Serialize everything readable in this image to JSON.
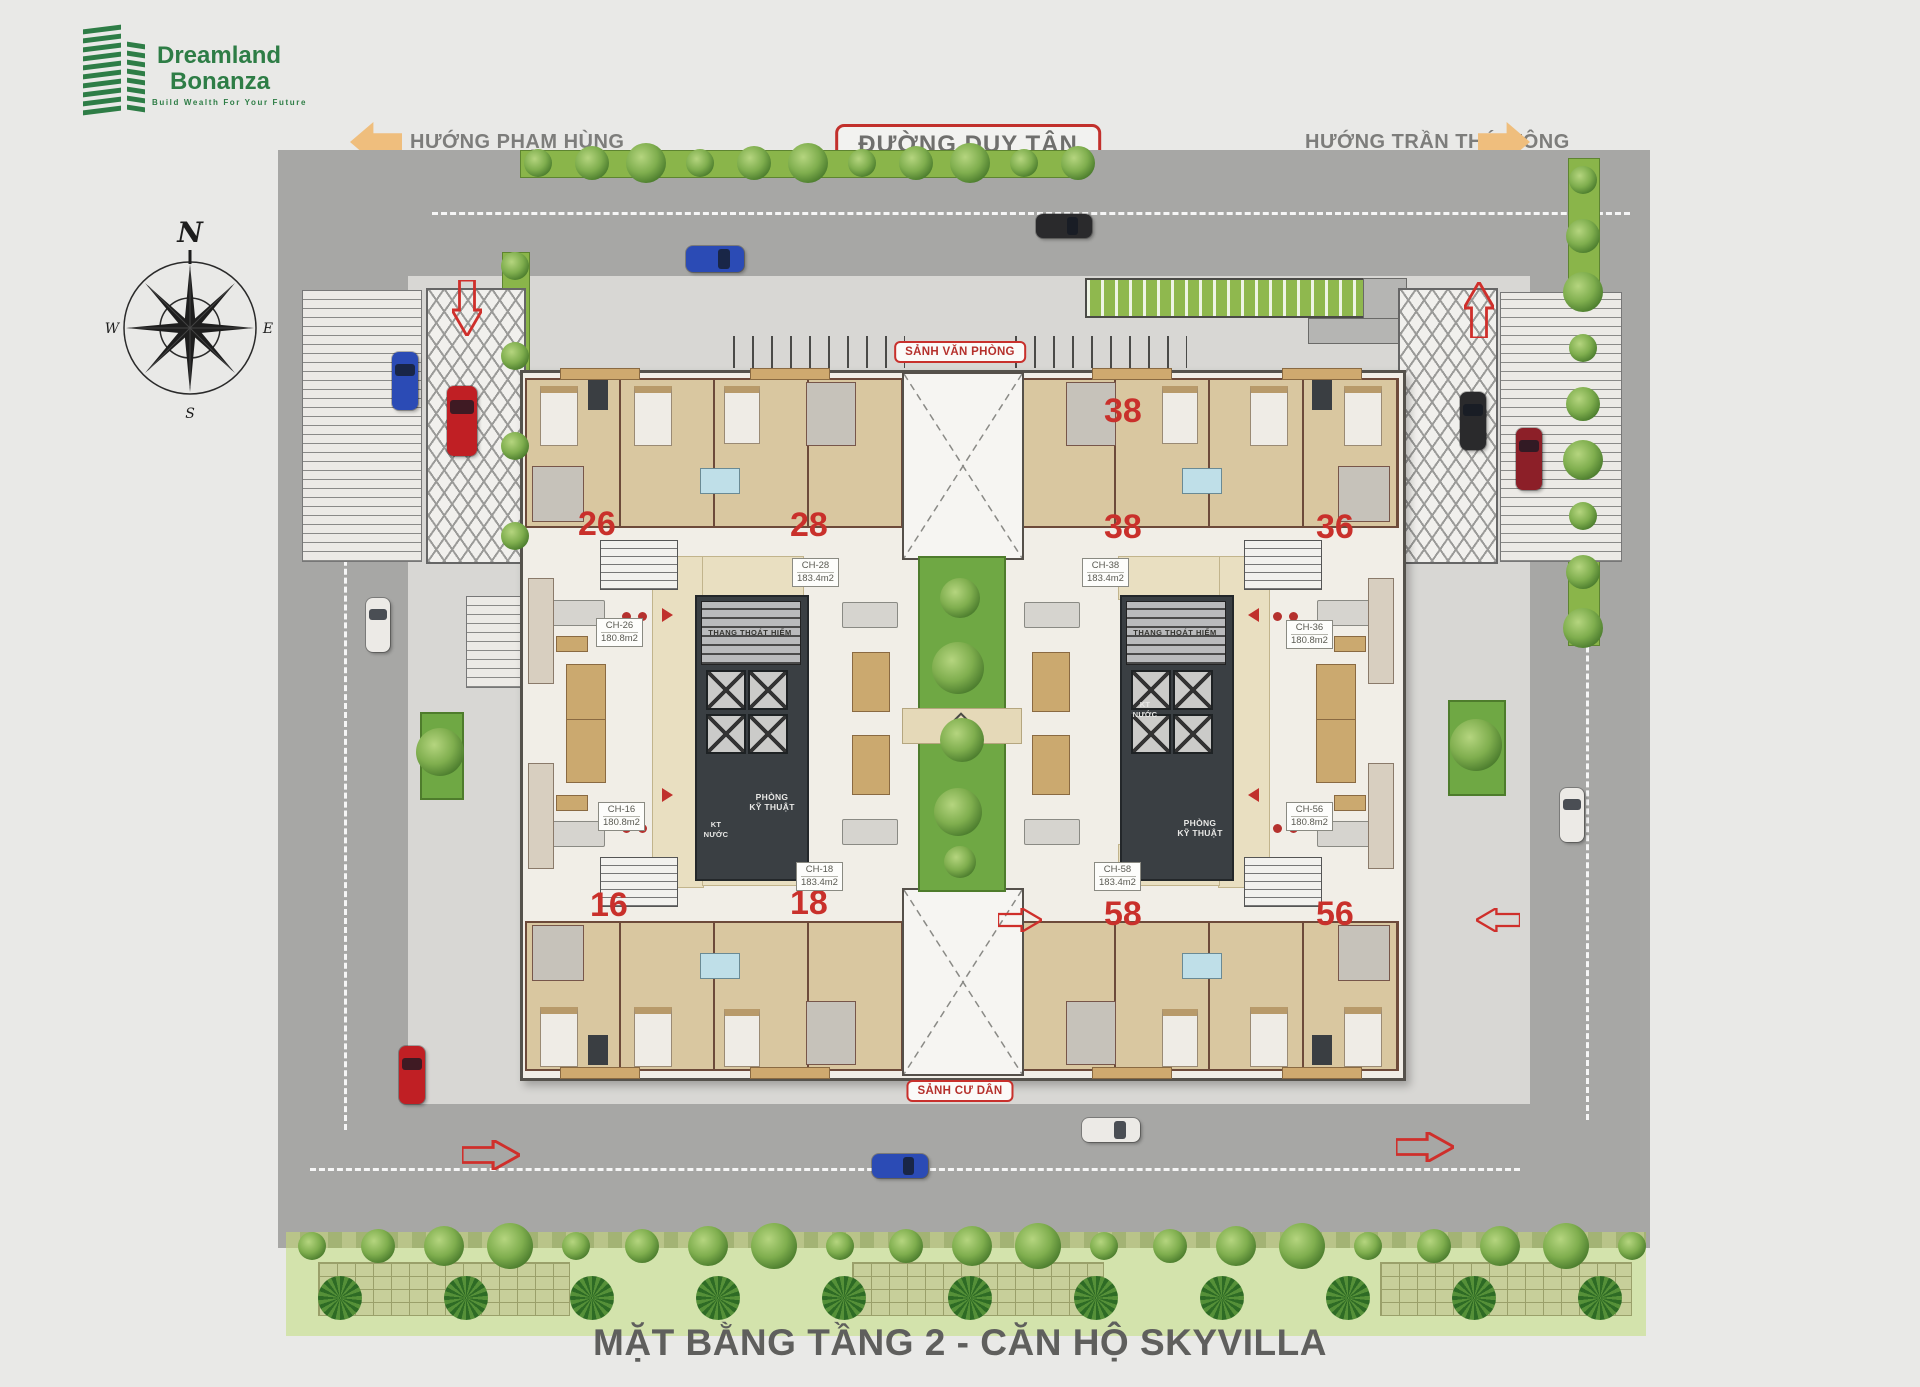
{
  "logo": {
    "name_line1": "Dreamland",
    "name_line2": "Bonanza",
    "tagline": "Build Wealth For Your Future"
  },
  "header": {
    "left_direction": "HƯỚNG PHẠM HÙNG",
    "main_road": "ĐƯỜNG DUY TÂN",
    "right_direction": "HƯỚNG TRẦN THÁI TÔNG"
  },
  "compass": {
    "north": "N",
    "east": "E",
    "south": "S",
    "west": "W"
  },
  "plan": {
    "office_lobby_label": "SẢNH VĂN PHÒNG",
    "resident_lobby_label": "SẢNH CƯ DÂN",
    "stair_label": "THANG THOÁT HIỂM",
    "tech_room_label_line1": "PHÒNG",
    "tech_room_label_line2": "KỸ THUẬT",
    "water_tech_label_line1": "KT",
    "water_tech_label_line2": "NƯỚC",
    "units": [
      {
        "number": "26",
        "code": "CH-26",
        "area": "180.8m2"
      },
      {
        "number": "28",
        "code": "CH-28",
        "area": "183.4m2"
      },
      {
        "number": "38",
        "code": "CH-38",
        "area": "183.4m2"
      },
      {
        "number": "36",
        "code": "CH-36",
        "area": "180.8m2"
      },
      {
        "number": "16",
        "code": "CH-16",
        "area": "180.8m2"
      },
      {
        "number": "18",
        "code": "CH-18",
        "area": "183.4m2"
      },
      {
        "number": "58",
        "code": "CH-58",
        "area": "183.4m2"
      },
      {
        "number": "56",
        "code": "CH-56",
        "area": "180.8m2"
      }
    ]
  },
  "footer": {
    "title": "MẶT BẰNG TẦNG 2 - CĂN HỘ SKYVILLA"
  },
  "colors": {
    "brand_green": "#2e7d46",
    "accent_red": "#c9302b",
    "arrow_orange": "#efbe7d",
    "road_label_gray": "#6f6f6d",
    "lawn_green": "#6fa844"
  }
}
